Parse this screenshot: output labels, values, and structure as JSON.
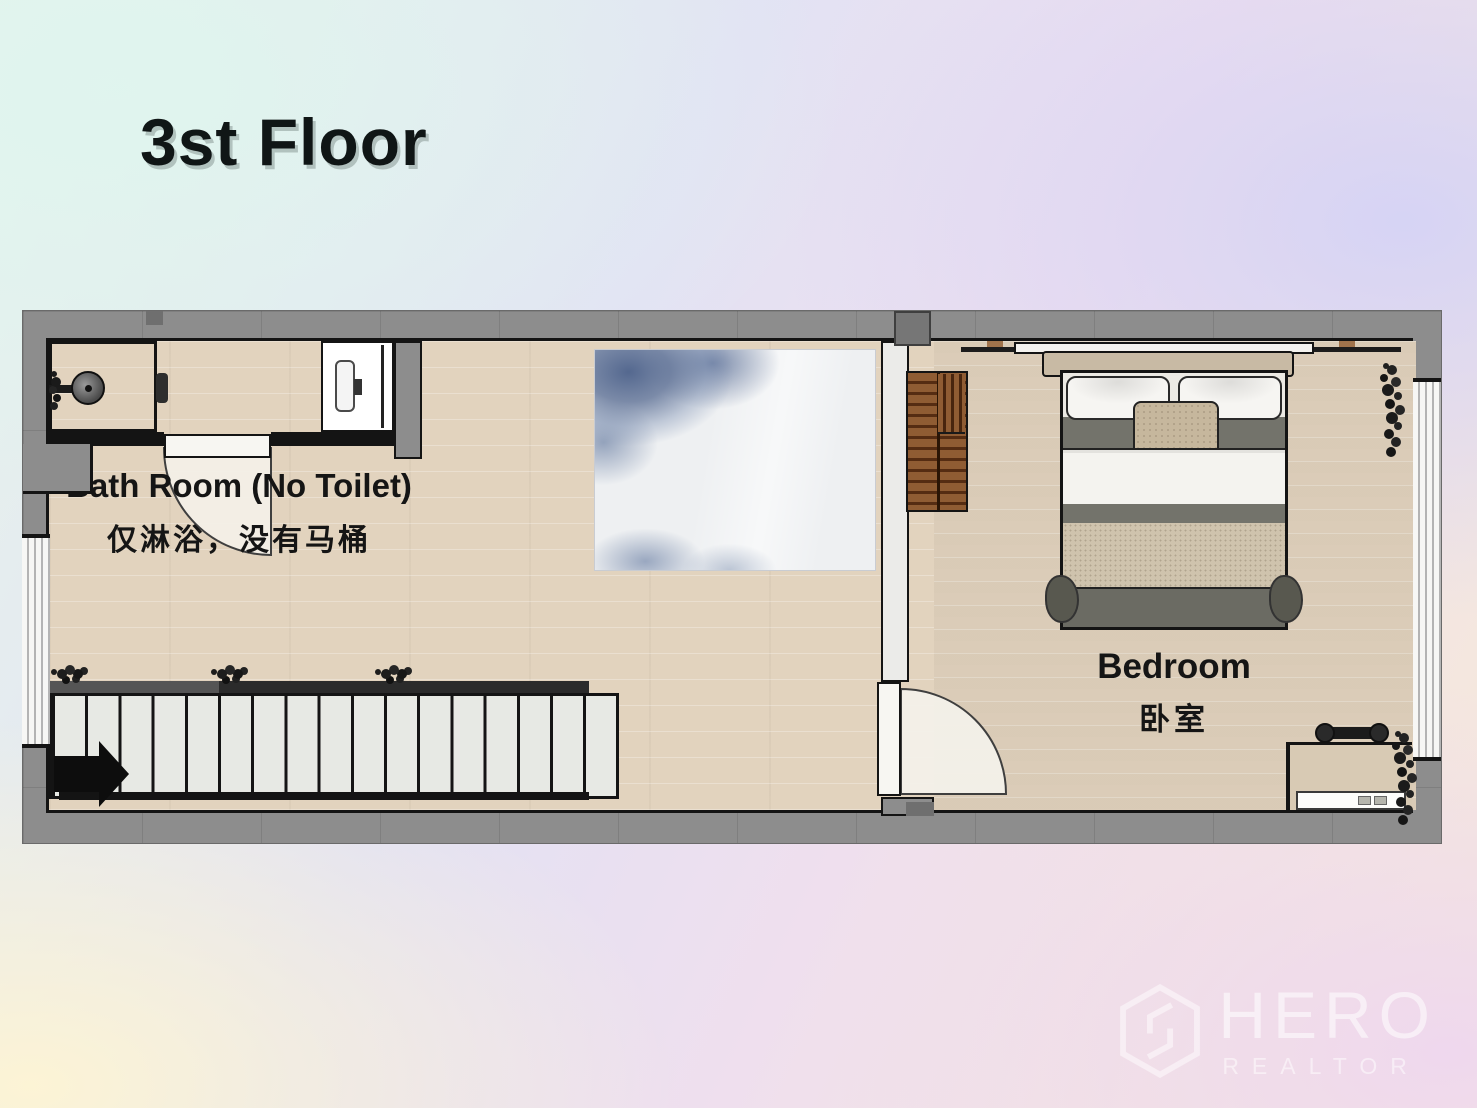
{
  "title": "3st Floor",
  "rooms": {
    "bathroom": {
      "label": "Bath Room (No Toilet)",
      "label_zh": "仅淋浴，没有马桶"
    },
    "bedroom": {
      "label": "Bedroom",
      "label_zh": "卧室"
    }
  },
  "stairs": {
    "step_count": 17,
    "direction": "right"
  },
  "watermark": {
    "brand": "HERO",
    "subtitle": "REALTOR"
  },
  "colors": {
    "wall_gray": "#8d8d8d",
    "outline_black": "#141414",
    "floor_wood": "#e9dcc8",
    "bedroom_floor": "#e1d4c0",
    "rug_blue": "#54688f",
    "wardrobe_brown": "#7e4e2a",
    "stair_tread": "#e7e9e4",
    "door_white": "#f7f6f2"
  }
}
